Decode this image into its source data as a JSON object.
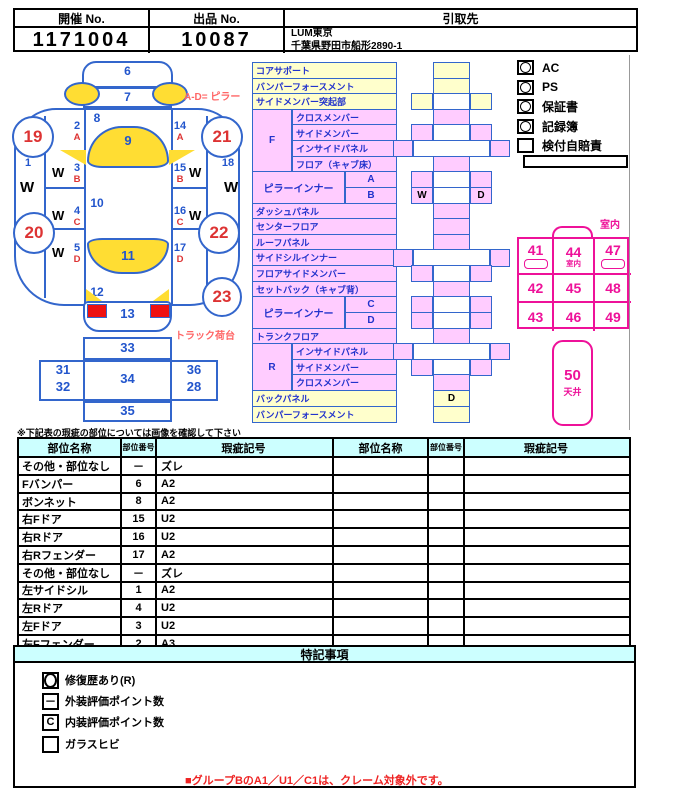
{
  "colors": {
    "pink": "#ffccff",
    "yellow": "#ffffcc",
    "glass_yellow": "#ffdd33",
    "line_blue": "#3366cc",
    "num_blue": "#2255cc",
    "red": "#dd3333",
    "magenta": "#ee1199",
    "header_cyan": "#ccffff",
    "warn_red": "#ee2222",
    "soft_red": "#ff6666"
  },
  "header": {
    "col1_label": "開催 No.",
    "col1_value": "1171004",
    "col2_label": "出品 No.",
    "col2_value": "10087",
    "col3_label": "引取先",
    "col3_line1": "LUM東京",
    "col3_line2": "千葉県野田市船形2890-1"
  },
  "car": {
    "front_bumper": "6",
    "bonnet": "7",
    "cowl": "8",
    "windshield": "9",
    "cabin": "10",
    "rear_window": "11",
    "rear_deck": "12",
    "rear_bumper": "13",
    "outer_left": {
      "num": "1",
      "w": "W"
    },
    "outer_right": {
      "num": "18",
      "w": "W"
    },
    "left_col": [
      {
        "num": "2",
        "letter": "A",
        "w": ""
      },
      {
        "num": "3",
        "letter": "B",
        "w": "W"
      },
      {
        "num": "4",
        "letter": "C",
        "w": "W"
      },
      {
        "num": "5",
        "letter": "D",
        "w": "W"
      }
    ],
    "right_col": [
      {
        "num": "14",
        "letter": "A",
        "w": ""
      },
      {
        "num": "15",
        "letter": "B",
        "w": "W"
      },
      {
        "num": "16",
        "letter": "C",
        "w": "W"
      },
      {
        "num": "17",
        "letter": "D",
        "w": ""
      }
    ],
    "wheels": {
      "fl": "19",
      "rl": "20",
      "fr": "21",
      "rr": "22"
    },
    "spare": "23",
    "pillar_note": "A-D= ピラー",
    "truck_note": "トラック荷台",
    "bed": {
      "front": "33",
      "left_top": "31",
      "left_bottom": "32",
      "center": "34",
      "right_top": "36",
      "right_bottom": "28",
      "rear": "35"
    }
  },
  "parts_rows": [
    {
      "t": "full",
      "label": "コアサポート",
      "bg": "y"
    },
    {
      "t": "full",
      "label": "バンパーフォースメント",
      "bg": "y"
    },
    {
      "t": "full",
      "label": "サイドメンバー突起部",
      "bg": "y"
    },
    {
      "t": "sub",
      "group": "F",
      "span": 4,
      "label": "クロスメンバー",
      "bg": "p"
    },
    {
      "t": "sub",
      "label": "サイドメンバー",
      "bg": "p"
    },
    {
      "t": "sub",
      "label": "インサイドパネル",
      "bg": "p"
    },
    {
      "t": "sub",
      "label": "フロア（キャブ床）",
      "bg": "p"
    },
    {
      "t": "pillar",
      "group": "ピラーインナー",
      "span": 2,
      "label": "A",
      "bg": "p"
    },
    {
      "t": "pillar",
      "label": "B",
      "bg": "p"
    },
    {
      "t": "full",
      "label": "ダッシュパネル",
      "bg": "p"
    },
    {
      "t": "full",
      "label": "センターフロア",
      "bg": "p"
    },
    {
      "t": "full",
      "label": "ルーフパネル",
      "bg": "p"
    },
    {
      "t": "full",
      "label": "サイドシルインナー",
      "bg": "p"
    },
    {
      "t": "full",
      "label": "フロアサイドメンバー",
      "bg": "p"
    },
    {
      "t": "full",
      "label": "セットバック（キャブ背）",
      "bg": "p"
    },
    {
      "t": "pillar",
      "group": "ピラーインナー",
      "span": 2,
      "label": "C",
      "bg": "p"
    },
    {
      "t": "pillar",
      "label": "D",
      "bg": "p"
    },
    {
      "t": "full",
      "label": "トランクフロア",
      "bg": "p"
    },
    {
      "t": "sub",
      "group": "R",
      "span": 3,
      "label": "インサイドパネル",
      "bg": "p"
    },
    {
      "t": "sub",
      "label": "サイドメンバー",
      "bg": "p"
    },
    {
      "t": "sub",
      "label": "クロスメンバー",
      "bg": "p"
    },
    {
      "t": "full",
      "label": "バックパネル",
      "bg": "y"
    },
    {
      "t": "full",
      "label": "バンパーフォースメント",
      "bg": "y"
    }
  ],
  "skeleton_rows": [
    {
      "t": "c",
      "bg": "y"
    },
    {
      "t": "c",
      "bg": "y"
    },
    {
      "t": "w",
      "bg": "y"
    },
    {
      "t": "c",
      "bg": "p"
    },
    {
      "t": "w",
      "bg": "p"
    },
    {
      "t": "o",
      "bg": "p"
    },
    {
      "t": "c",
      "bg": "p"
    },
    {
      "t": "w",
      "bg": "p"
    },
    {
      "t": "w",
      "bg": "p",
      "lm": "W",
      "rm": "D"
    },
    {
      "t": "c",
      "bg": "p"
    },
    {
      "t": "c",
      "bg": "p"
    },
    {
      "t": "c",
      "bg": "p"
    },
    {
      "t": "o",
      "bg": "p"
    },
    {
      "t": "w",
      "bg": "p"
    },
    {
      "t": "c",
      "bg": "p"
    },
    {
      "t": "w",
      "bg": "p"
    },
    {
      "t": "w",
      "bg": "p"
    },
    {
      "t": "c",
      "bg": "p"
    },
    {
      "t": "o",
      "bg": "p"
    },
    {
      "t": "w",
      "bg": "p"
    },
    {
      "t": "c",
      "bg": "p"
    },
    {
      "t": "c",
      "bg": "y",
      "cm": "D"
    },
    {
      "t": "c",
      "bg": "y"
    }
  ],
  "equipment": [
    {
      "label": "AC",
      "mark": "circle"
    },
    {
      "label": "PS",
      "mark": "circle"
    },
    {
      "label": "保証書",
      "mark": "circle"
    },
    {
      "label": "記録簿",
      "mark": "circle"
    },
    {
      "label": "検付自賠責",
      "mark": "none"
    }
  ],
  "interior": {
    "corner_label": "室内",
    "grid": [
      [
        "41",
        "44",
        "47"
      ],
      [
        "42",
        "45",
        "48"
      ],
      [
        "43",
        "46",
        "49"
      ]
    ],
    "center_sub": "室内",
    "ceiling_num": "50",
    "ceiling_label": "天井"
  },
  "damage_table": {
    "note": "※下記表の瑕疵の部位については画像を確認して下さい",
    "headers": [
      "部位名称",
      "部位番号",
      "瑕疵記号"
    ],
    "left_rows": [
      [
        "その他・部位なし",
        "－",
        "ズレ"
      ],
      [
        "Fバンパー",
        "6",
        "A2"
      ],
      [
        "ボンネット",
        "8",
        "A2"
      ],
      [
        "右Fドア",
        "15",
        "U2"
      ],
      [
        "右Rドア",
        "16",
        "U2"
      ],
      [
        "右Rフェンダー",
        "17",
        "A2"
      ],
      [
        "その他・部位なし",
        "－",
        "ズレ"
      ],
      [
        "左サイドシル",
        "1",
        "A2"
      ],
      [
        "左Rドア",
        "4",
        "U2"
      ],
      [
        "左Fドア",
        "3",
        "U2"
      ],
      [
        "左Fフェンダー",
        "2",
        "A3"
      ]
    ],
    "right_rows": [
      [
        "",
        "",
        ""
      ],
      [
        "",
        "",
        ""
      ],
      [
        "",
        "",
        ""
      ],
      [
        "",
        "",
        ""
      ],
      [
        "",
        "",
        ""
      ],
      [
        "",
        "",
        ""
      ],
      [
        "",
        "",
        ""
      ],
      [
        "",
        "",
        ""
      ],
      [
        "",
        "",
        ""
      ],
      [
        "",
        "",
        ""
      ],
      [
        "",
        "",
        ""
      ]
    ]
  },
  "notes": {
    "title": "特記事項",
    "legend": [
      {
        "mark": "circle",
        "label": "修復歴あり(R)"
      },
      {
        "mark": "－",
        "label": "外装評価ポイント数"
      },
      {
        "mark": "C",
        "label": "内装評価ポイント数"
      },
      {
        "mark": "",
        "label": "ガラスヒビ"
      }
    ],
    "warning": "■グループBのA1／U1／C1は、クレーム対象外です。"
  }
}
